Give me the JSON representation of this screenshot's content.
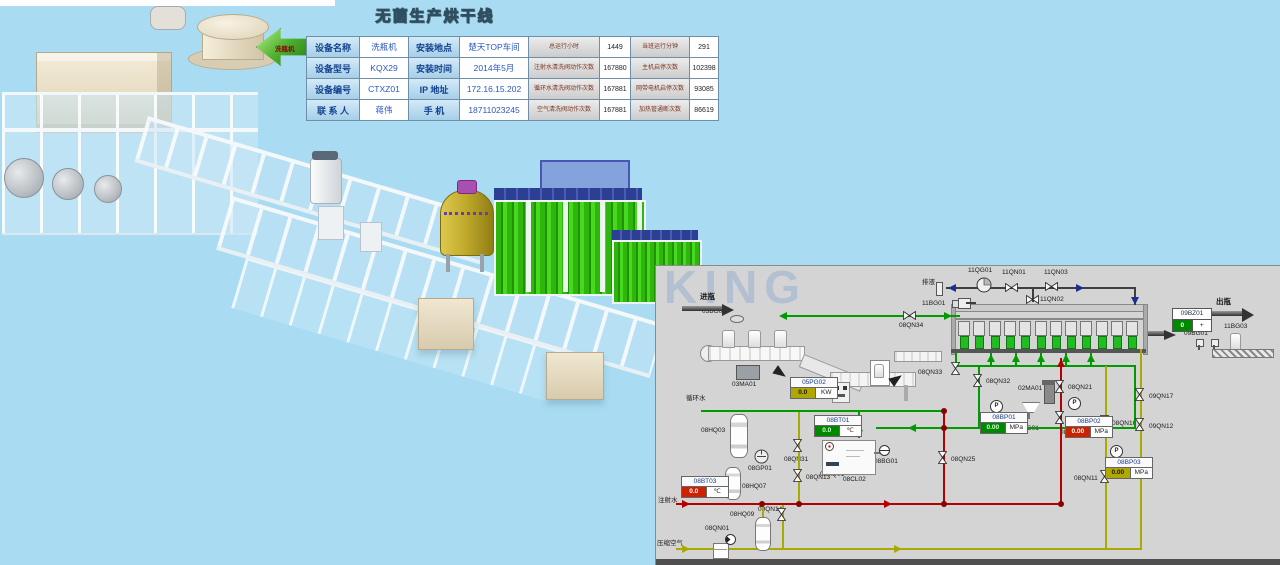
{
  "screen": {
    "title": "无菌生产烘干线"
  },
  "nav_arrow": {
    "label": "洗瓶机"
  },
  "info_table": {
    "rows": [
      {
        "c1": "设备名称",
        "v1": "洗瓶机",
        "c2": "安装地点",
        "v2": "楚天TOP车间",
        "c3": "总运行小时",
        "v3": "1449",
        "c4": "当班运行分钟",
        "v4": "291"
      },
      {
        "c1": "设备型号",
        "v1": "KQX29",
        "c2": "安装时间",
        "v2": "2014年5月",
        "c3": "注射水清洗阀动作次数",
        "v3": "167880",
        "c4": "主机启停次数",
        "v4": "102398"
      },
      {
        "c1": "设备编号",
        "v1": "CTXZ01",
        "c2": "IP 地址",
        "v2": "172.16.15.202",
        "c3": "循环水清洗阀动作次数",
        "v3": "167881",
        "c4": "网带电机启停次数",
        "v4": "93085"
      },
      {
        "c1": "联 系 人",
        "v1": "蒋伟",
        "c2": "手  机",
        "v2": "18711023245",
        "c3": "空气清洗阀动作次数",
        "v3": "167881",
        "c4": "加热管通断次数",
        "v4": "86619"
      }
    ]
  },
  "diagram": {
    "watermark": "KING",
    "counter": {
      "tag": "09BZ01",
      "value": "0",
      "plus": "+"
    },
    "labels": [
      {
        "t": "进瓶",
        "x": 44,
        "y": 27,
        "big": 1
      },
      {
        "t": "出瓶",
        "x": 560,
        "y": 32,
        "big": 1
      },
      {
        "t": "排液",
        "x": 266,
        "y": 14
      },
      {
        "t": "循环水",
        "x": 30,
        "y": 130
      },
      {
        "t": "注射水",
        "x": 2,
        "y": 232
      },
      {
        "t": "压缩空气",
        "x": 1,
        "y": 275
      },
      {
        "t": "11QG01",
        "x": 312,
        "y": 2
      },
      {
        "t": "11QN01",
        "x": 346,
        "y": 4
      },
      {
        "t": "11QN03",
        "x": 388,
        "y": 4
      },
      {
        "t": "11QN02",
        "x": 384,
        "y": 31
      },
      {
        "t": "11BG01",
        "x": 266,
        "y": 35
      },
      {
        "t": "03BG01",
        "x": 46,
        "y": 43
      },
      {
        "t": "03MA01",
        "x": 76,
        "y": 116
      },
      {
        "t": "08QN34",
        "x": 243,
        "y": 57
      },
      {
        "t": "08QN33",
        "x": 262,
        "y": 104
      },
      {
        "t": "08QN32",
        "x": 330,
        "y": 113
      },
      {
        "t": "02MA01",
        "x": 362,
        "y": 120
      },
      {
        "t": "02BG01",
        "x": 359,
        "y": 160
      },
      {
        "t": "08QN21",
        "x": 412,
        "y": 119
      },
      {
        "t": "08QN24",
        "x": 404,
        "y": 164
      },
      {
        "t": "08QN16",
        "x": 456,
        "y": 155
      },
      {
        "t": "09QN17",
        "x": 493,
        "y": 128
      },
      {
        "t": "09QN12",
        "x": 493,
        "y": 158
      },
      {
        "t": "08QN11",
        "x": 418,
        "y": 210
      },
      {
        "t": "08QN25",
        "x": 295,
        "y": 191
      },
      {
        "t": "08QN31",
        "x": 128,
        "y": 191
      },
      {
        "t": "08QN13",
        "x": 150,
        "y": 209
      },
      {
        "t": "09QN14",
        "x": 102,
        "y": 241
      },
      {
        "t": "08QN01",
        "x": 49,
        "y": 260
      },
      {
        "t": "08HQ03",
        "x": 45,
        "y": 162
      },
      {
        "t": "08GP01",
        "x": 92,
        "y": 200
      },
      {
        "t": "08HQ01",
        "x": 164,
        "y": 206
      },
      {
        "t": "08CL02",
        "x": 187,
        "y": 211
      },
      {
        "t": "08BG01",
        "x": 218,
        "y": 193
      },
      {
        "t": "08HQ07",
        "x": 86,
        "y": 218
      },
      {
        "t": "08HQ09",
        "x": 74,
        "y": 246
      },
      {
        "t": "09BG01",
        "x": 528,
        "y": 65
      },
      {
        "t": "11BG03",
        "x": 568,
        "y": 58
      }
    ],
    "displays": [
      {
        "tag": "05PG02",
        "value": "0.0",
        "unit": "KW",
        "cls": "olive",
        "x": 134,
        "y": 111
      },
      {
        "tag": "08BT01",
        "value": "0.0",
        "unit": "℃",
        "cls": "green",
        "x": 158,
        "y": 149
      },
      {
        "tag": "08BP01",
        "value": "0.00",
        "unit": "MPa",
        "cls": "green",
        "x": 324,
        "y": 146
      },
      {
        "tag": "08BP02",
        "value": "0.00",
        "unit": "MPa",
        "cls": "red",
        "x": 409,
        "y": 150
      },
      {
        "tag": "08BP03",
        "value": "0.00",
        "unit": "MPa",
        "cls": "olive",
        "x": 449,
        "y": 191
      },
      {
        "tag": "08BT03",
        "value": "0.0",
        "unit": "℃",
        "cls": "red",
        "x": 25,
        "y": 210
      }
    ],
    "valves": [
      [
        349,
        17,
        0,
        "11QN01"
      ],
      [
        389,
        16,
        0,
        "11QN03"
      ],
      [
        370,
        29,
        0,
        "11QN02"
      ],
      [
        247,
        45,
        0,
        "08QN34"
      ],
      [
        293,
        98,
        90,
        "08QN33"
      ],
      [
        315,
        110,
        90,
        "08QN32"
      ],
      [
        397,
        116,
        90,
        "08QN21"
      ],
      [
        397,
        147,
        90,
        "08QN24"
      ],
      [
        442,
        151,
        90,
        "08QN16"
      ],
      [
        477,
        124,
        90,
        "09QN17"
      ],
      [
        477,
        154,
        90,
        "09QN12"
      ],
      [
        442,
        206,
        90,
        "08QN11"
      ],
      [
        280,
        187,
        90,
        "08QN25"
      ],
      [
        135,
        175,
        90,
        "08QN31"
      ],
      [
        135,
        205,
        90,
        "08QN13"
      ],
      [
        119,
        244,
        90,
        "09QN14"
      ]
    ],
    "pipes": [
      [
        130,
        49,
        174,
        2,
        "g"
      ],
      [
        45,
        144,
        244,
        2,
        "g"
      ],
      [
        202,
        145,
        2,
        27,
        "g"
      ],
      [
        220,
        161,
        260,
        2,
        "g"
      ],
      [
        478,
        100,
        2,
        62,
        "g"
      ],
      [
        300,
        99,
        180,
        2,
        "g"
      ],
      [
        322,
        100,
        2,
        61,
        "g"
      ],
      [
        299,
        87,
        2,
        14,
        "g"
      ],
      [
        334,
        87,
        2,
        13,
        "g"
      ],
      [
        359,
        87,
        2,
        13,
        "g"
      ],
      [
        384,
        87,
        2,
        13,
        "g"
      ],
      [
        409,
        87,
        2,
        13,
        "g"
      ],
      [
        434,
        87,
        2,
        13,
        "g"
      ],
      [
        20,
        237,
        386,
        2,
        "r"
      ],
      [
        287,
        146,
        2,
        92,
        "r"
      ],
      [
        404,
        92,
        2,
        146,
        "r"
      ],
      [
        20,
        282,
        466,
        2,
        "y"
      ],
      [
        449,
        100,
        2,
        183,
        "y"
      ],
      [
        484,
        83,
        2,
        200,
        "y"
      ],
      [
        106,
        239,
        2,
        44,
        "y"
      ],
      [
        126,
        239,
        2,
        44,
        "y"
      ],
      [
        142,
        146,
        2,
        92,
        "y"
      ],
      [
        290,
        21,
        190,
        2,
        "k"
      ],
      [
        478,
        22,
        2,
        17,
        "k"
      ],
      [
        376,
        23,
        2,
        13,
        "k"
      ],
      [
        310,
        36,
        10,
        2,
        "k"
      ]
    ],
    "arrows": [
      [
        123,
        46,
        "l",
        "g"
      ],
      [
        288,
        46,
        "r",
        "g"
      ],
      [
        199,
        164,
        "d",
        "g"
      ],
      [
        252,
        158,
        "l",
        "g"
      ],
      [
        416,
        158,
        "l",
        "g"
      ],
      [
        331,
        88,
        "u",
        "g"
      ],
      [
        356,
        88,
        "u",
        "g"
      ],
      [
        381,
        88,
        "u",
        "g"
      ],
      [
        406,
        88,
        "u",
        "g"
      ],
      [
        431,
        88,
        "u",
        "g"
      ],
      [
        26,
        234,
        "r",
        "r"
      ],
      [
        228,
        234,
        "r",
        "r"
      ],
      [
        401,
        93,
        "u",
        "r"
      ],
      [
        26,
        279,
        "r",
        "y"
      ],
      [
        238,
        279,
        "r",
        "y"
      ],
      [
        292,
        18,
        "l",
        "b"
      ],
      [
        420,
        18,
        "r",
        "b"
      ],
      [
        475,
        31,
        "d",
        "b"
      ]
    ],
    "dots": [
      [
        285,
        142
      ],
      [
        285,
        159
      ],
      [
        285,
        235
      ],
      [
        402,
        235
      ],
      [
        140,
        235
      ],
      [
        103,
        235
      ]
    ],
    "tanks": [
      [
        74,
        148,
        16,
        42,
        "tank-08HQ03"
      ],
      [
        69,
        201,
        14,
        31,
        "tank-08HQ07"
      ],
      [
        99,
        251,
        14,
        32,
        "tank-08HQ09"
      ]
    ],
    "circles": [
      [
        320,
        11,
        "pump",
        "pump-11QG01"
      ],
      [
        334,
        134,
        "p",
        "pressure-sensor"
      ],
      [
        412,
        131,
        "p",
        "pressure-sensor"
      ],
      [
        454,
        179,
        "p",
        "pressure-sensor"
      ],
      [
        56,
        218,
        "gauge",
        "gauge"
      ],
      [
        69,
        268,
        "gaugen",
        "gauge-08QN01"
      ],
      [
        98,
        183,
        "pump2",
        "pump-08GP01"
      ],
      [
        169,
        176,
        "therm",
        "thermometer"
      ],
      [
        223,
        179,
        "level",
        "level-sensor-08BG01"
      ]
    ],
    "washer": {
      "chambers": 12,
      "bottles": 12
    }
  }
}
